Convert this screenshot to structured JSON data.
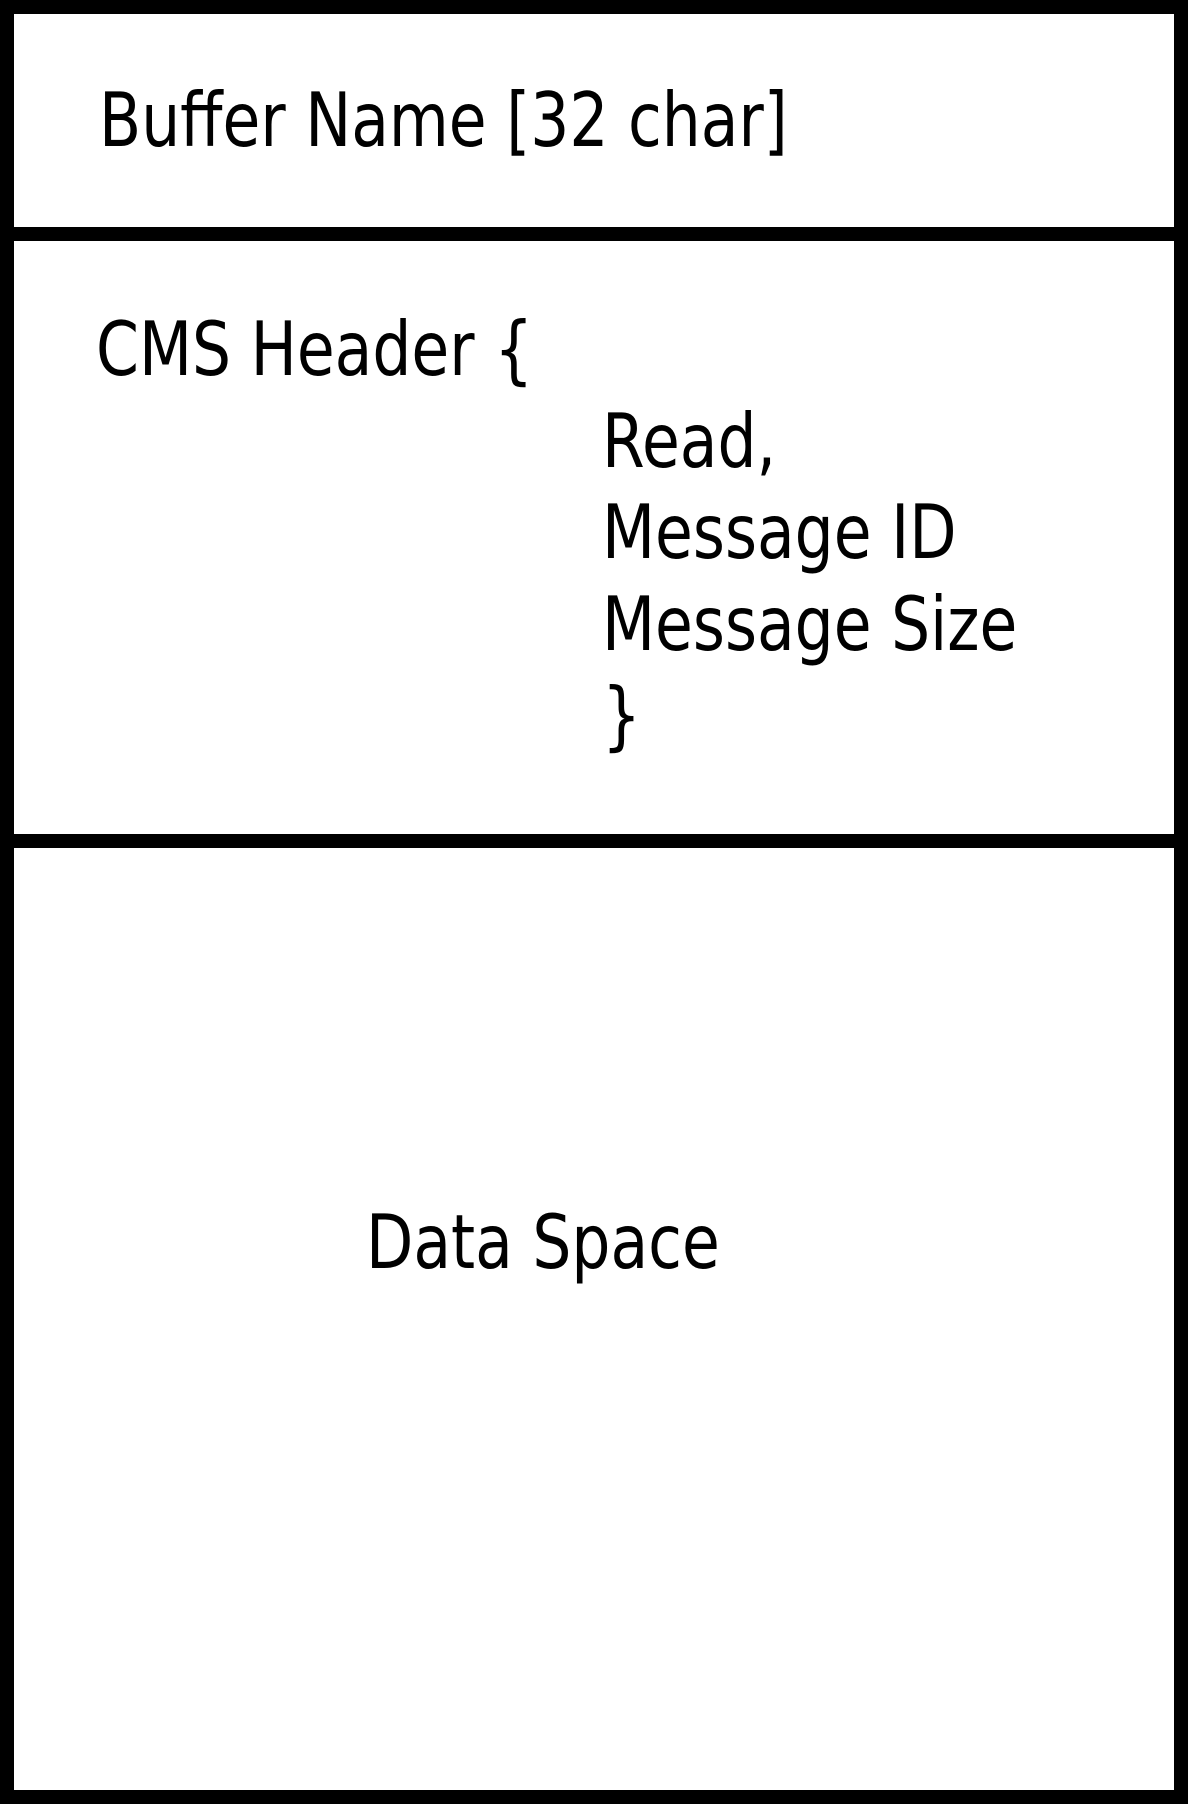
{
  "diagram": {
    "kind": "memory-buffer-layout",
    "colors": {
      "background": "#ffffff",
      "line": "#000000",
      "text": "#000000"
    },
    "sections": {
      "buffer_name": {
        "label": "Buffer Name [32 char]"
      },
      "cms_header": {
        "open": "CMS Header {",
        "fields": [
          "Read,",
          "Message ID",
          "Message Size"
        ],
        "close": "}"
      },
      "data_space": {
        "label": "Data Space"
      }
    }
  }
}
